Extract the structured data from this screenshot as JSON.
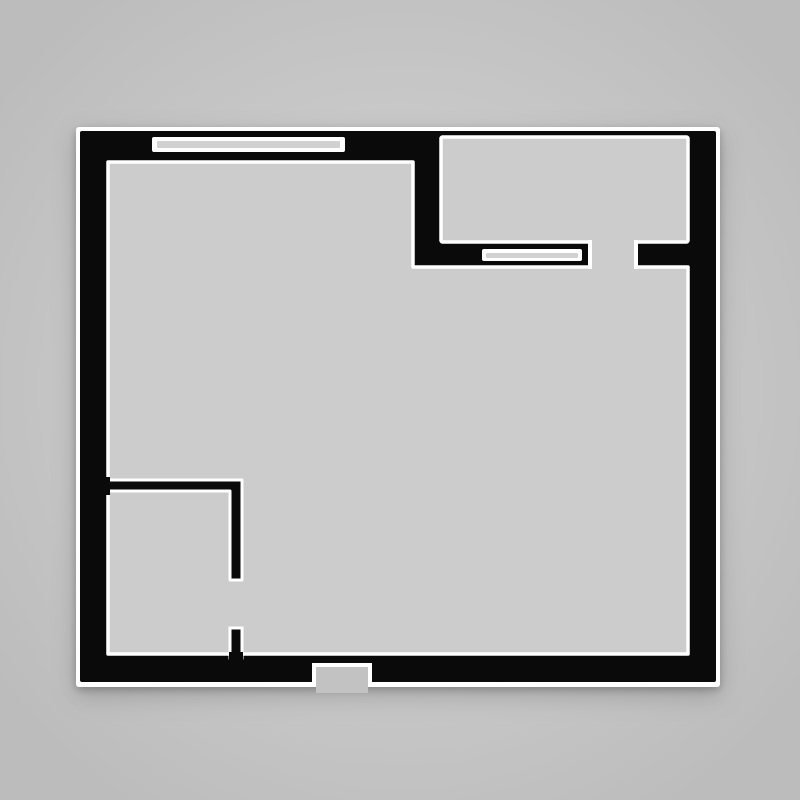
{
  "plan": {
    "kind": "architectural-floor-plan",
    "description": "Black-wall floor plan of a single unit on a gray background: one large main room, a smaller room at top-right, a partitioned nook at bottom-left, two windows, two interior doorways and a bottom entry opening.",
    "rooms": [
      {
        "name": "main-room"
      },
      {
        "name": "top-right-room"
      },
      {
        "name": "bottom-left-nook"
      }
    ],
    "windows": [
      {
        "name": "top-wall-window"
      },
      {
        "name": "interior-wall-window"
      }
    ],
    "openings": [
      {
        "name": "top-right-room-doorway"
      },
      {
        "name": "nook-doorway"
      },
      {
        "name": "bottom-entry-opening"
      }
    ]
  },
  "colors": {
    "background": "#c9c9c9",
    "background_edge": "#bcbcbc",
    "wall": "#0a0a0a",
    "outline": "#ffffff",
    "floor": "#cccccc",
    "glass": "#d1d1d1",
    "entry_floor": "#c2c2c2"
  }
}
